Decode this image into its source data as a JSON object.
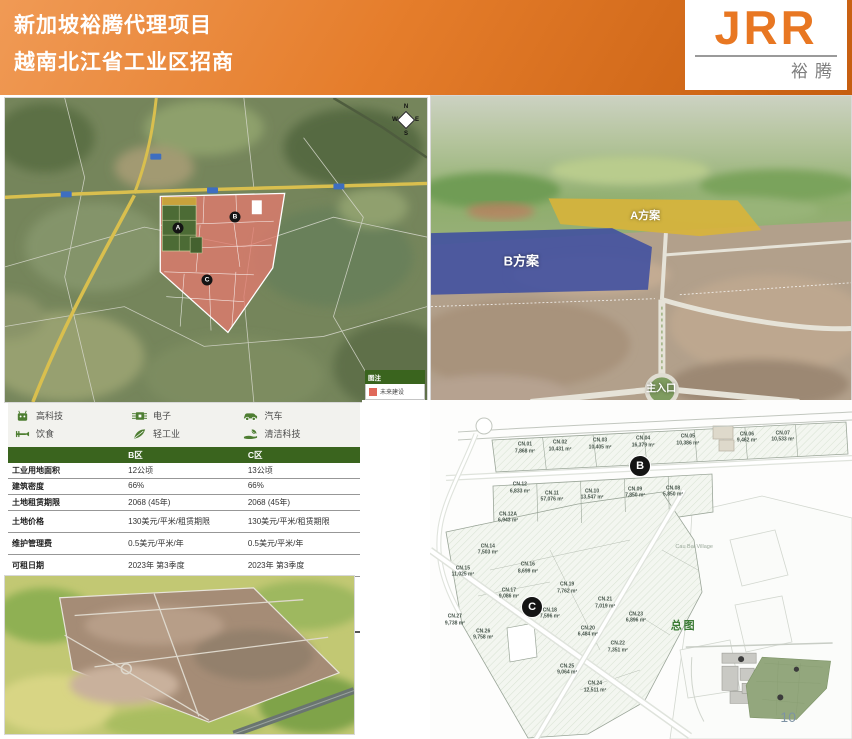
{
  "header": {
    "title_line1": "新加坡裕腾代理项目",
    "title_line2": "越南北江省工业区招商",
    "logo_text": "JRR",
    "logo_subtext": "裕腾",
    "accent_color": "#E87722"
  },
  "satellite_map": {
    "compass": {
      "n": "N",
      "e": "E",
      "s": "S",
      "w": "W"
    },
    "markers": [
      {
        "label": "A",
        "x": 41.0,
        "y": 42.8
      },
      {
        "label": "B",
        "x": 54.5,
        "y": 39.2
      },
      {
        "label": "C",
        "x": 47.9,
        "y": 59.8
      }
    ],
    "legend": {
      "title": "图注",
      "item_label": "未来建设",
      "swatch_color": "#E0695A"
    }
  },
  "aerial_photo": {
    "plan_a_label": "A方案",
    "plan_b_label": "B方案",
    "entrance_label": "主入口",
    "plan_a_color": "#D8B43A",
    "plan_b_color": "#3F4FA0"
  },
  "industries": [
    {
      "icon": "robot-icon",
      "label": "高科技"
    },
    {
      "icon": "circuit-board-icon",
      "label": "电子"
    },
    {
      "icon": "car-icon",
      "label": "汽车"
    },
    {
      "icon": "fork-icon",
      "label": "饮食"
    },
    {
      "icon": "feather-icon",
      "label": "轻工业"
    },
    {
      "icon": "clean-tech-icon",
      "label": "清洁科技"
    }
  ],
  "spec_table": {
    "header_b": "B区",
    "header_c": "C区",
    "rows": [
      {
        "label": "工业用地面积",
        "b": "12公顷",
        "c": "13公顷"
      },
      {
        "label": "建筑密度",
        "b": "66%",
        "c": "66%"
      },
      {
        "label": "土地租赁期限",
        "b": "2068 (45年)",
        "c": "2068 (45年)"
      },
      {
        "label": "土地价格",
        "b": "130美元/平米/租赁期限",
        "c": "130美元/平米/租赁期限",
        "tall": true
      },
      {
        "label": "维护管理费",
        "b": "0.5美元/平米/年",
        "c": "0.5美元/平米/年",
        "tall": true
      },
      {
        "label": "可租日期",
        "b": "2023年 第3季度",
        "c": "2023年 第3季度",
        "tall": true
      }
    ],
    "payment": {
      "label": "付款条款",
      "lines": [
        "订金: 30%",
        "签土地租赁合同时: 30%",
        "土地交接时: 30%",
        "红本交接时: 剩下的10%"
      ]
    }
  },
  "siteplan": {
    "markers": [
      {
        "label": "B",
        "x": 49.8,
        "y": 19.5
      },
      {
        "label": "C",
        "x": 24.2,
        "y": 61.1
      }
    ],
    "village_label": "Cau Bai Village",
    "overview_title": "总图",
    "page_number": "10",
    "lots": [
      {
        "id": "CN.01",
        "area": "7,868 m²",
        "x": 22.5,
        "y": 14.2
      },
      {
        "id": "CN.02",
        "area": "10,431 m²",
        "x": 30.8,
        "y": 13.6
      },
      {
        "id": "CN.03",
        "area": "10,405 m²",
        "x": 40.3,
        "y": 13.0
      },
      {
        "id": "CN.04",
        "area": "16,379 m²",
        "x": 50.5,
        "y": 12.4
      },
      {
        "id": "CN.05",
        "area": "10,386 m²",
        "x": 61.1,
        "y": 11.8
      },
      {
        "id": "CN.06",
        "area": "9,462 m²",
        "x": 75.1,
        "y": 11.2
      },
      {
        "id": "CN.07",
        "area": "10,533 m²",
        "x": 83.6,
        "y": 10.8
      },
      {
        "id": "CN.12",
        "area": "6,833 m²",
        "x": 21.3,
        "y": 26.0
      },
      {
        "id": "CN.11",
        "area": "57,076 m²",
        "x": 28.9,
        "y": 28.5
      },
      {
        "id": "CN.10",
        "area": "13,547 m²",
        "x": 38.4,
        "y": 28.0
      },
      {
        "id": "CN.09",
        "area": "7,850 m²",
        "x": 48.6,
        "y": 27.4
      },
      {
        "id": "CN.08",
        "area": "5,850 m²",
        "x": 57.6,
        "y": 27.0
      },
      {
        "id": "CN.12A",
        "area": "6,943 m²",
        "x": 18.5,
        "y": 34.8
      },
      {
        "id": "CN.14",
        "area": "7,503 m²",
        "x": 13.7,
        "y": 44.2
      },
      {
        "id": "CN.15",
        "area": "11,025 m²",
        "x": 7.8,
        "y": 50.7
      },
      {
        "id": "CN.16",
        "area": "8,699 m²",
        "x": 23.2,
        "y": 49.6
      },
      {
        "id": "CN.19",
        "area": "7,762 m²",
        "x": 32.5,
        "y": 55.5
      },
      {
        "id": "CN.17",
        "area": "9,086 m²",
        "x": 18.7,
        "y": 57.2
      },
      {
        "id": "CN.18",
        "area": "7,596 m²",
        "x": 28.4,
        "y": 63.1
      },
      {
        "id": "CN.21",
        "area": "7,019 m²",
        "x": 41.5,
        "y": 59.9
      },
      {
        "id": "CN.23",
        "area": "6,896 m²",
        "x": 48.8,
        "y": 64.3
      },
      {
        "id": "CN.27",
        "area": "9,738 m²",
        "x": 5.9,
        "y": 64.9
      },
      {
        "id": "CN.20",
        "area": "6,484 m²",
        "x": 37.4,
        "y": 68.4
      },
      {
        "id": "CN.26",
        "area": "9,758 m²",
        "x": 12.6,
        "y": 69.3
      },
      {
        "id": "CN.22",
        "area": "7,351 m²",
        "x": 44.5,
        "y": 72.9
      },
      {
        "id": "CN.25",
        "area": "9,064 m²",
        "x": 32.5,
        "y": 79.6
      },
      {
        "id": "CN.24",
        "area": "12,511 m²",
        "x": 39.1,
        "y": 84.7
      }
    ]
  }
}
